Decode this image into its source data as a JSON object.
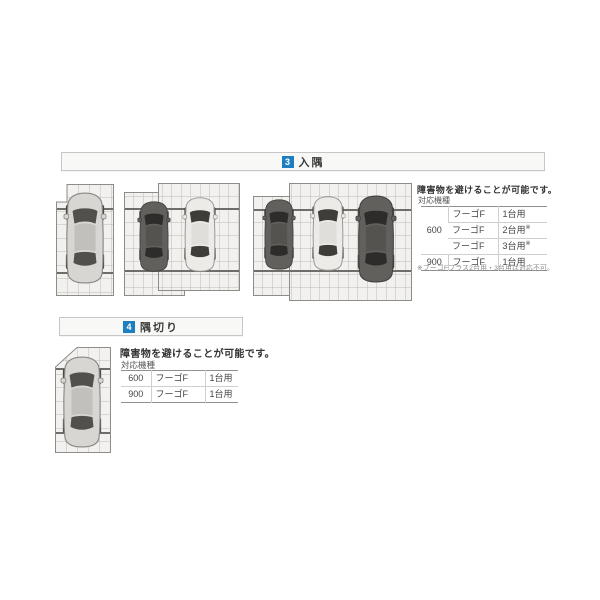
{
  "accent_color": "#1e7fc0",
  "section_irizumi": {
    "badge": "3",
    "title": "入隅",
    "description": "障害物を避けることが可能です。",
    "spec_label": "対応機種",
    "table": {
      "rows": [
        {
          "size": "600",
          "model": "フーゴF",
          "capacity": "1台用",
          "mark": ""
        },
        {
          "model": "フーゴF",
          "capacity": "2台用",
          "mark": "※"
        },
        {
          "model": "フーゴF",
          "capacity": "3台用",
          "mark": "※"
        },
        {
          "size": "900",
          "model": "フーゴF",
          "capacity": "1台用",
          "mark": ""
        }
      ]
    },
    "footnote": "※フーゴFプラス2台用・3台用は対応不可。",
    "diagrams": [
      {
        "name": "carport-1bay-inside-corner",
        "cars": [
          "silver"
        ]
      },
      {
        "name": "carport-2bay-inside-corner",
        "cars": [
          "dark",
          "white"
        ]
      },
      {
        "name": "carport-3bay-inside-corner",
        "cars": [
          "dark",
          "white",
          "dark"
        ]
      }
    ]
  },
  "section_sumikiri": {
    "badge": "4",
    "title": "隅切り",
    "description": "障害物を避けることが可能です。",
    "spec_label": "対応機種",
    "table": {
      "rows": [
        {
          "size": "600",
          "model": "フーゴF",
          "capacity": "1台用"
        },
        {
          "size": "900",
          "model": "フーゴF",
          "capacity": "1台用"
        }
      ]
    },
    "diagrams": [
      {
        "name": "carport-1bay-corner-cut",
        "cars": [
          "silver"
        ]
      }
    ]
  }
}
